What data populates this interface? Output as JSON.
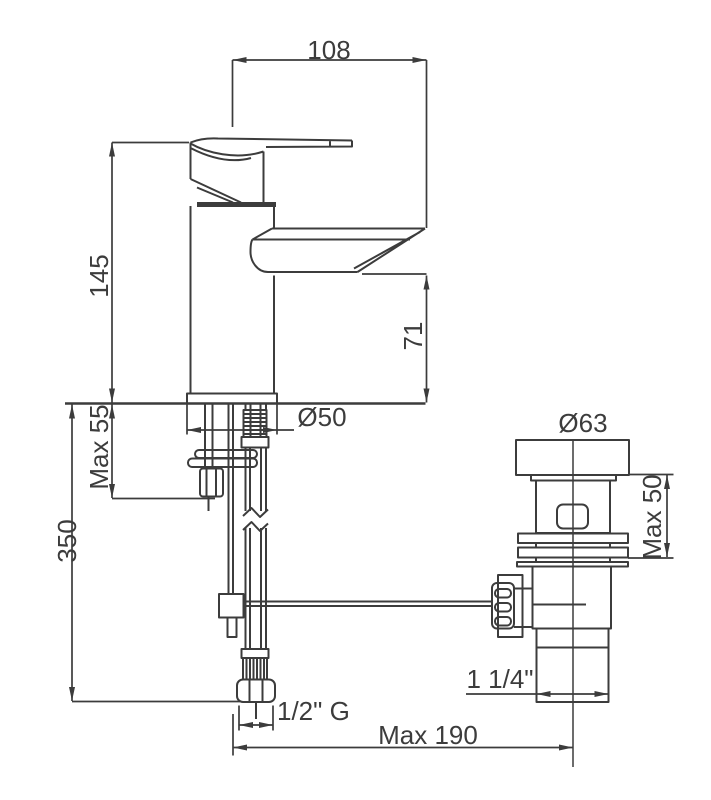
{
  "figure": {
    "title": "Basin mixer tap with pop-up waste — installation dimension drawing",
    "colors": {
      "line": "#3c3c3c",
      "background": "#ffffff"
    }
  },
  "dimensions": {
    "spout_reach": "108",
    "body_height": "145",
    "spout_clearance": "71",
    "deck_thickness_max": "Max 55",
    "supply_hose_length": "350",
    "base_diameter": "Ø50",
    "waste_cap_diameter": "Ø63",
    "waste_deck_max": "Max 50",
    "waste_outlet_size": "1 1/4\"",
    "supply_thread": "1/2\" G",
    "axis_distance_max": "Max 190"
  }
}
